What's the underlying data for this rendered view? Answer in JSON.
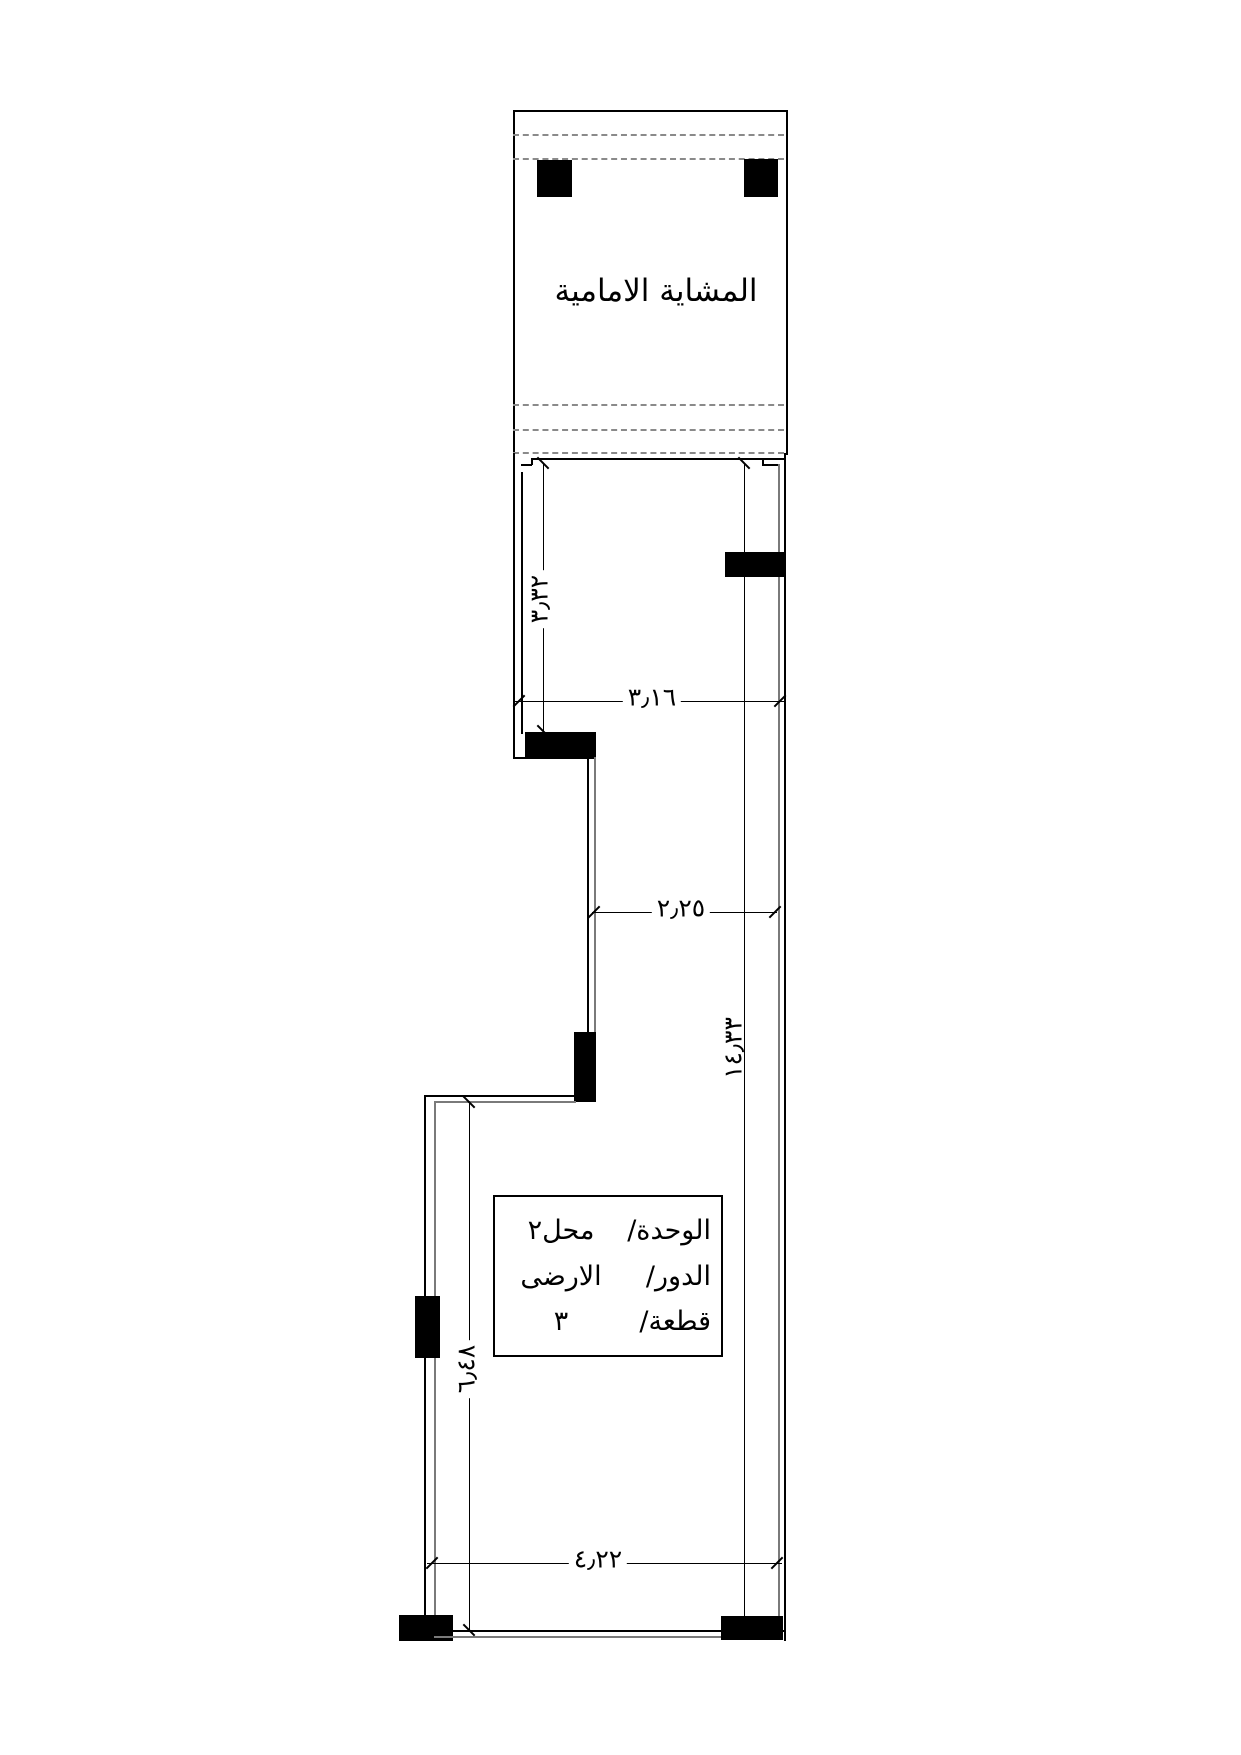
{
  "walkway": {
    "label": "المشاية الامامية"
  },
  "unit_box": {
    "rows": [
      {
        "label": "الوحدة/",
        "value": "محل٢"
      },
      {
        "label": "الدور/",
        "value": "الارضى"
      },
      {
        "label": "قطعة/",
        "value": "٣"
      }
    ]
  },
  "dimensions": {
    "upper_room_height": "٣٫٣٢",
    "upper_room_width": "٣٫١٦",
    "middle_width": "٢٫٢٥",
    "overall_height": "١٤٫٣٣",
    "lower_left_height": "٦٫٤٨",
    "bottom_width": "٤٫٢٢"
  },
  "colors": {
    "line": "#000000",
    "inner_wall_line": "#7a7a7a",
    "dashed_line": "#8a8a8a",
    "column_fill": "#000000",
    "background": "#ffffff"
  }
}
